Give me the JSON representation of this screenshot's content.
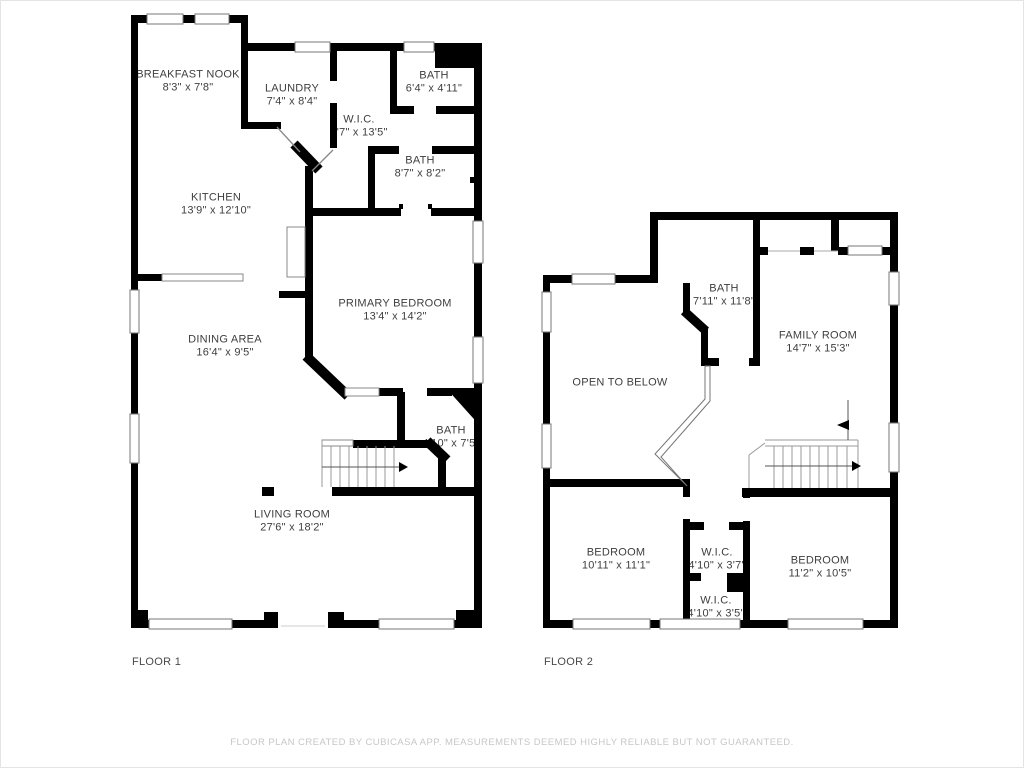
{
  "floor1": {
    "title": "FLOOR 1",
    "rooms": {
      "breakfast_nook": {
        "name": "BREAKFAST NOOK",
        "dims": "8'3\" x 7'8\""
      },
      "laundry": {
        "name": "LAUNDRY",
        "dims": "7'4\" x 8'4\""
      },
      "bath_top": {
        "name": "BATH",
        "dims": "6'4\" x 4'11\""
      },
      "wic": {
        "name": "W.I.C.",
        "dims": "5'7\" x 13'5\""
      },
      "bath_mid": {
        "name": "BATH",
        "dims": "8'7\" x 8'2\""
      },
      "kitchen": {
        "name": "KITCHEN",
        "dims": "13'9\" x 12'10\""
      },
      "primary_bedroom": {
        "name": "PRIMARY BEDROOM",
        "dims": "13'4\" x 14'2\""
      },
      "dining_area": {
        "name": "DINING AREA",
        "dims": "16'4\" x 9'5\""
      },
      "bath_stairs": {
        "name": "BATH",
        "dims": "4'10\" x 7'5\""
      },
      "living_room": {
        "name": "LIVING ROOM",
        "dims": "27'6\" x 18'2\""
      }
    }
  },
  "floor2": {
    "title": "FLOOR 2",
    "rooms": {
      "bath": {
        "name": "BATH",
        "dims": "7'11\" x 11'8\""
      },
      "family_room": {
        "name": "FAMILY ROOM",
        "dims": "14'7\" x 15'3\""
      },
      "open_to_below": {
        "name": "OPEN TO BELOW",
        "dims": ""
      },
      "bedroom_left": {
        "name": "BEDROOM",
        "dims": "10'11\" x 11'1\""
      },
      "wic_upper": {
        "name": "W.I.C.",
        "dims": "4'10\" x 3'7\""
      },
      "bedroom_right": {
        "name": "BEDROOM",
        "dims": "11'2\" x 10'5\""
      },
      "wic_lower": {
        "name": "W.I.C.",
        "dims": "4'10\" x 3'5\""
      }
    }
  },
  "footer": {
    "disclaimer": "FLOOR PLAN CREATED BY CUBICASA APP. MEASUREMENTS DEEMED HIGHLY RELIABLE BUT NOT GUARANTEED."
  },
  "colors": {
    "wall": "#000000",
    "label_text": "#3e3e3e",
    "footer_text": "#c7c7c7",
    "thin_line": "#888888"
  }
}
